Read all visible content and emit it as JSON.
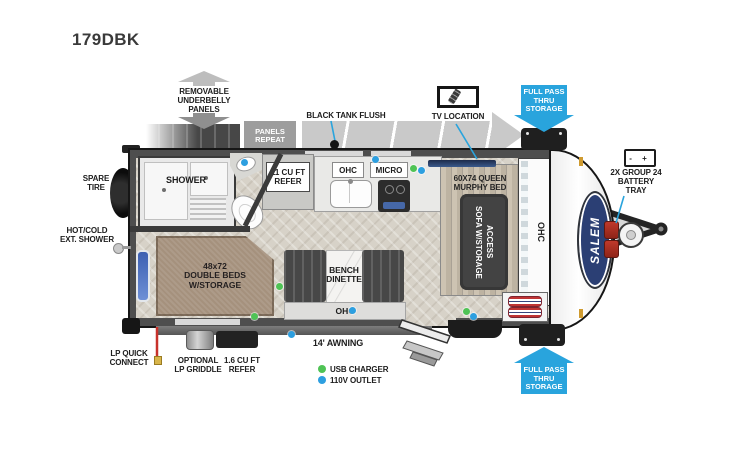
{
  "title": "179DBK",
  "brand": "SALEM",
  "underbelly": {
    "arrow_label": "REMOVABLE\nUNDERBELLY\nPANELS",
    "panels_repeat": "PANELS\nREPEAT"
  },
  "callouts": {
    "black_tank_flush": "BLACK TANK FLUSH",
    "tv_location": "TV LOCATION",
    "pass_thru": "FULL PASS\nTHRU\nSTORAGE",
    "battery_tray": "2X GROUP 24\nBATTERY\nTRAY",
    "battery_icon_text": "- +",
    "spare_tire": "SPARE\nTIRE",
    "ext_shower": "HOT/COLD\nEXT. SHOWER",
    "lp_quick_connect": "LP QUICK\nCONNECT",
    "optional_griddle": "OPTIONAL\nLP GRIDDLE",
    "small_refer": "1.6 CU FT\nREFER",
    "awning": "14' AWNING"
  },
  "rooms": {
    "shower": "SHOWER",
    "refer": "11 CU FT\nREFER",
    "ohc": "OHC",
    "micro": "MICRO",
    "murphy_bed": "60X74 QUEEN\nMURPHY BED",
    "sofa": "SOFA W/STORAGE\nACCESS",
    "double_beds": "48x72\nDOUBLE BEDS\nW/STORAGE",
    "dinette": "BENCH\nDINETTE"
  },
  "legend": {
    "usb": "USB CHARGER",
    "outlet": "110V OUTLET"
  },
  "colors": {
    "callout_blue": "#29a4dd",
    "usb_green": "#4fc355",
    "outlet_blue": "#2d9fe0",
    "lp_red": "#c8322b"
  }
}
